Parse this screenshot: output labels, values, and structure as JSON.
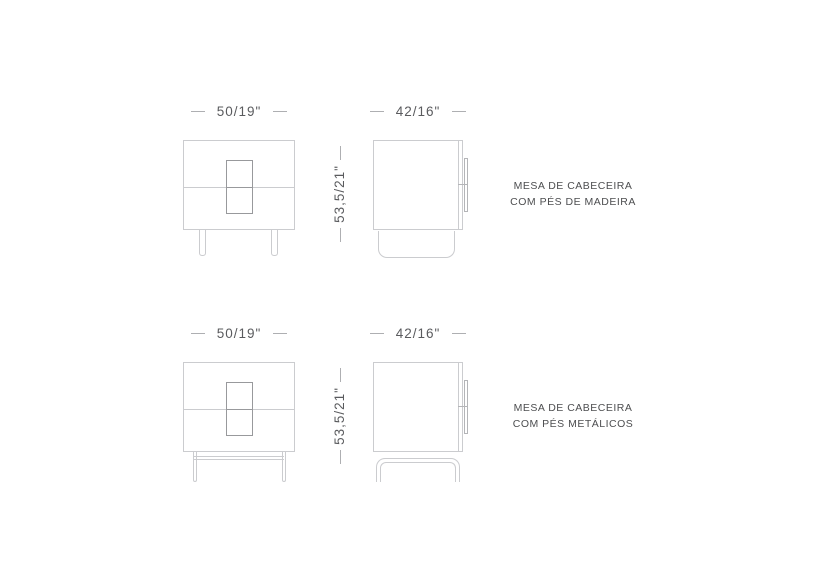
{
  "colors": {
    "background": "#ffffff",
    "outline": "#cbcccf",
    "handle_outline": "#98999c",
    "dimension_text": "#5a5b5e",
    "dimension_dash": "#aeafb2",
    "label_text": "#4d4e50"
  },
  "rows": [
    {
      "variant": "wooden-legs",
      "front_width_dim": "50/19\"",
      "side_depth_dim": "42/16\"",
      "height_dim": "53,5/21\"",
      "label_line1": "MESA DE CABECEIRA",
      "label_line2": "COM PÉS DE MADEIRA"
    },
    {
      "variant": "metal-legs",
      "front_width_dim": "50/19\"",
      "side_depth_dim": "42/16\"",
      "height_dim": "53,5/21\"",
      "label_line1": "MESA DE CABECEIRA",
      "label_line2": "COM PÉS METÁLICOS"
    }
  ]
}
